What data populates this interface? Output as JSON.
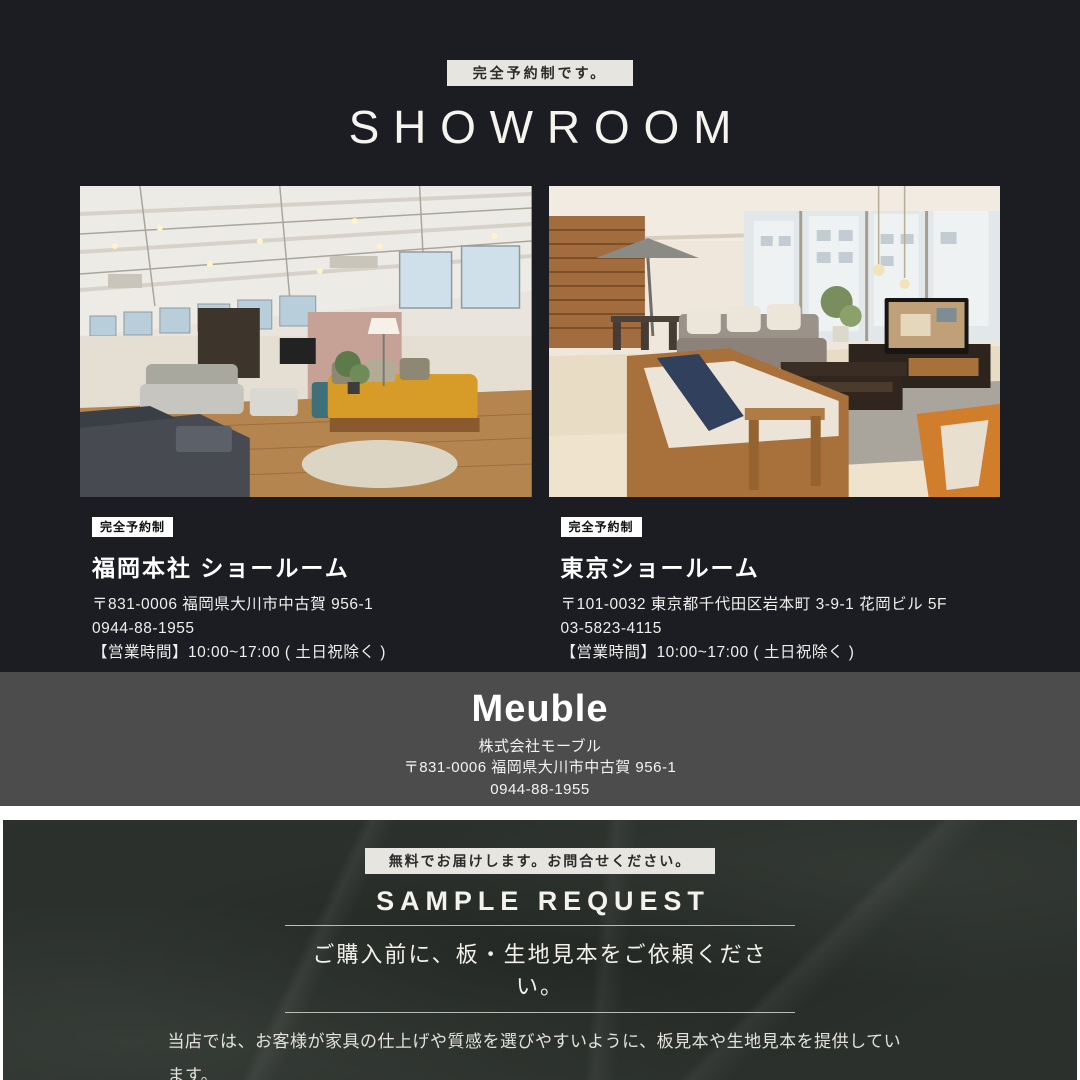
{
  "showroom": {
    "badge": "完全予約制です。",
    "title": "SHOWROOM",
    "locations": [
      {
        "badge": "完全予約制",
        "name": "福岡本社 ショールーム",
        "address": "〒831-0006 福岡県大川市中古賀 956-1",
        "phone": "0944-88-1955",
        "hours": "【営業時間】10:00~17:00 ( 土日祝除く )"
      },
      {
        "badge": "完全予約制",
        "name": "東京ショールーム",
        "address": "〒101-0032 東京都千代田区岩本町 3-9-1 花岡ビル 5F",
        "phone": "03-5823-4115",
        "hours": "【営業時間】10:00~17:00 ( 土日祝除く )"
      }
    ]
  },
  "company": {
    "logo": "Meuble",
    "name": "株式会社モーブル",
    "address": "〒831-0006 福岡県大川市中古賀 956-1",
    "phone": "0944-88-1955"
  },
  "sample_request": {
    "badge": "無料でお届けします。お問合せください。",
    "title": "SAMPLE REQUEST",
    "lead": "ご購入前に、板・生地見本をご依頼ください。",
    "description_line1": "当店では、お客様が家具の仕上げや質感を選びやすいように、板見本や生地見本を提供しています。",
    "description_line2": "ぜひ、サンプルをお取り寄せいただき色味や木目をお手元でご確認ください。"
  },
  "colors": {
    "top_bg": "#1b1d23",
    "gray_bg": "#4c4c4d",
    "marble_bg": "#2b302c",
    "badge_bg": "#e6e5df",
    "text": "#ffffff"
  }
}
